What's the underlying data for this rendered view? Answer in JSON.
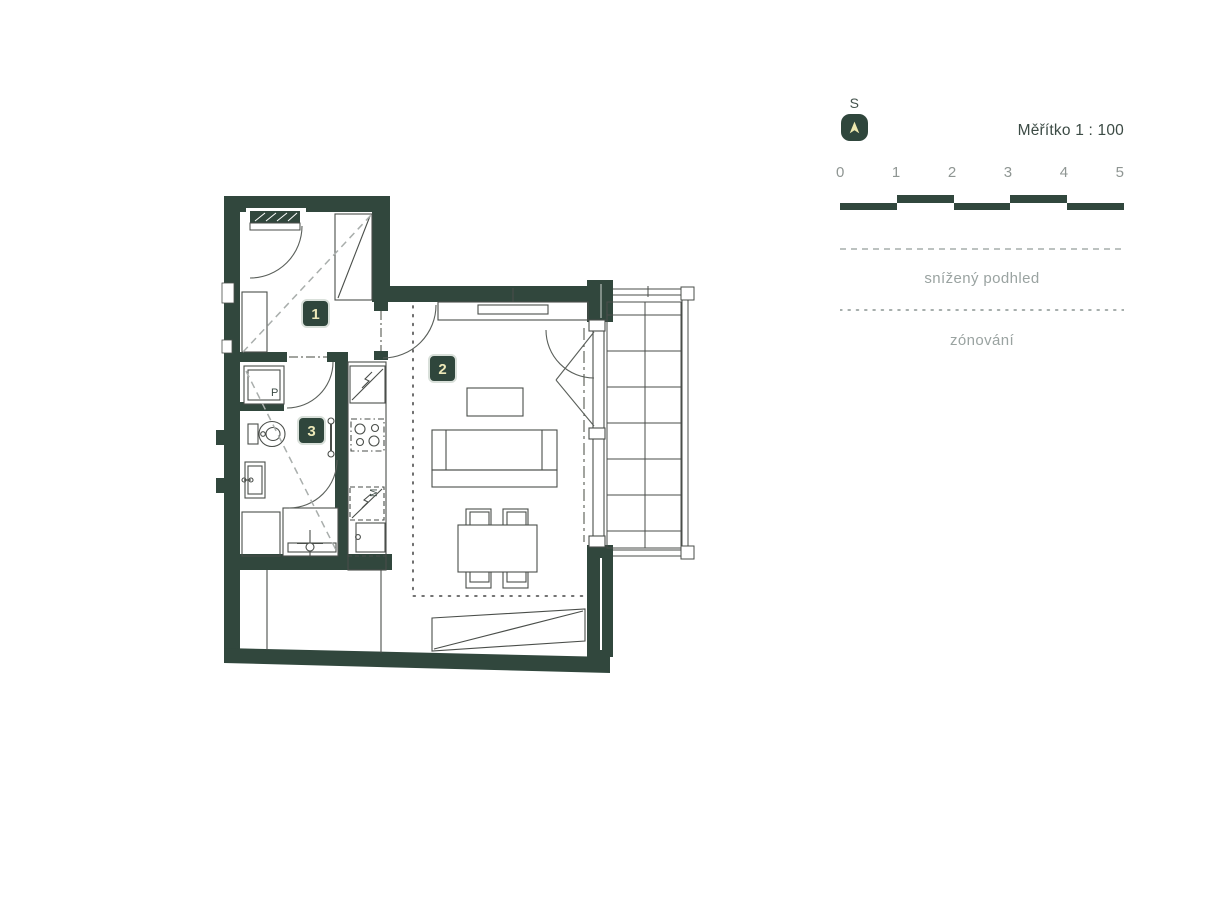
{
  "legend": {
    "north": {
      "label": "S"
    },
    "scale": {
      "label": "Měřítko 1 : 100",
      "ticks": [
        "0",
        "1",
        "2",
        "3",
        "4",
        "5"
      ]
    },
    "lowered_ceiling": {
      "label": "snížený podhled"
    },
    "zoning": {
      "label": "zónování"
    }
  },
  "floorplan": {
    "rooms": [
      {
        "number": "1"
      },
      {
        "number": "2"
      },
      {
        "number": "3"
      }
    ],
    "appliances": {
      "washer": "P",
      "dishwasher": "M"
    }
  },
  "colors": {
    "wall": "#31473d",
    "badge": "#2f463c",
    "badge_text": "#ece8b8",
    "muted_text": "#9aa3a1",
    "dark_text": "#3c4b45",
    "compass_arrow": "#ede7ae"
  }
}
